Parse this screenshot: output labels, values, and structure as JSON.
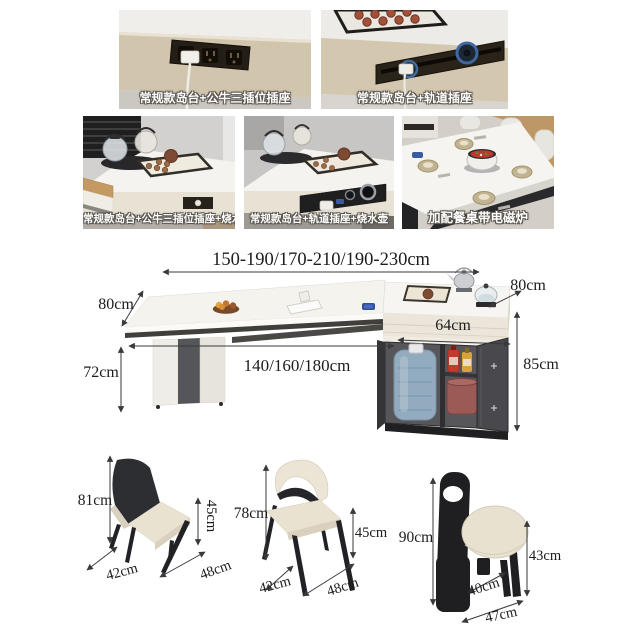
{
  "palette": {
    "annotation_text": "#1c1c1c",
    "caption_text": "#ffffff",
    "caption_outline": "#5a554e",
    "table_beige": "#d3c6ae",
    "socket_panel_dark": "#241e16",
    "track_ring_blue": "#3f68a0",
    "cabinet_dark": "#48484d",
    "water_jug_blue": "#93abbe",
    "bucket_maroon": "#9b5a55",
    "cushion_cream": "#e8e1d1",
    "chair_black": "#26262a"
  },
  "photo_grid": {
    "row1": [
      {
        "caption": "常规款岛台+公牛三插位插座"
      },
      {
        "caption": "常规款岛台+轨道插座"
      }
    ],
    "row2": [
      {
        "caption": "常规款岛台+公牛三插位插座+烧水壶"
      },
      {
        "caption": "常规款岛台+轨道插座+烧水壶"
      },
      {
        "caption": "加配餐桌带电磁炉"
      }
    ]
  },
  "dimension_diagram": {
    "total_length_range": "150-190/170-210/190-230cm",
    "tabletop_depth_left": "80cm",
    "island_depth_right": "80cm",
    "island_width": "64cm",
    "fixed_table_length": "140/160/180cm",
    "table_height": "72cm",
    "island_height": "85cm"
  },
  "chairs": [
    {
      "back_height": "81cm",
      "seat_height": "45cm",
      "seat_depth": "42cm",
      "seat_width": "48cm"
    },
    {
      "back_height": "78cm",
      "seat_height": "45cm",
      "seat_depth": "42cm",
      "seat_width": "48cm"
    },
    {
      "back_height": "90cm",
      "seat_height": "43cm",
      "seat_depth": "40cm",
      "seat_width": "47cm"
    }
  ]
}
